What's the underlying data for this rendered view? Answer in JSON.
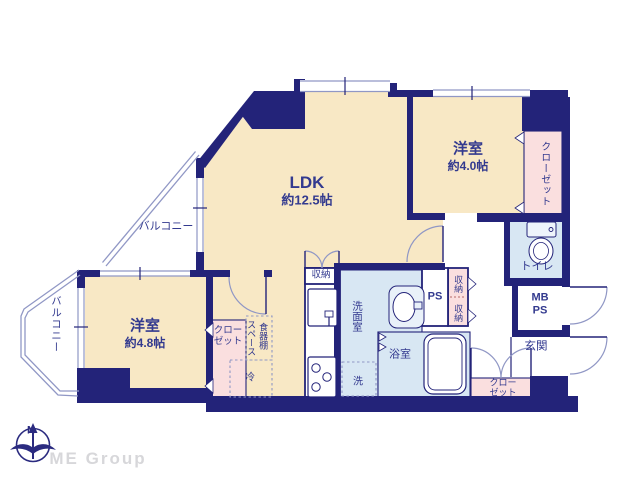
{
  "floorplan": {
    "rooms": {
      "ldk": {
        "label": "LDK",
        "area": "約12.5帖"
      },
      "bedroom_right": {
        "label": "洋室",
        "area": "約4.0帖"
      },
      "bedroom_left": {
        "label": "洋室",
        "area": "約4.8帖"
      },
      "balcony_upper": {
        "label": "バルコニー"
      },
      "balcony_left": {
        "label": "バルコニー"
      },
      "toilet": {
        "label": "トイレ"
      },
      "meter_box": {
        "line1": "MB",
        "line2": "PS"
      },
      "entrance": {
        "label": "玄関"
      },
      "washroom": {
        "label": "洗面室"
      },
      "bathroom": {
        "label": "浴室"
      },
      "closet_right": {
        "label": "クローゼット"
      },
      "closet_left": {
        "line1": "クロー",
        "line2": "ゼット"
      },
      "closet_entrance": {
        "line1": "クロー",
        "line2": "ゼット"
      },
      "storage_kitchen": {
        "label": "収納"
      },
      "storage_hall_upper": {
        "label": "収納"
      },
      "storage_hall_lower": {
        "label": "収納"
      },
      "pipe_space": {
        "label": "PS"
      },
      "cupboard_space": {
        "line1": "食器棚",
        "line2": "スペース"
      },
      "refrigerator": {
        "label": "冷"
      },
      "washer": {
        "label": "洗"
      }
    },
    "compass": {
      "north_label": "N"
    },
    "logo": {
      "text": "ME Group"
    },
    "colors": {
      "wall": "#232379",
      "floor_cream": "#f8e8c5",
      "closet_pink": "#fadfdf",
      "water_blue": "#d8e7f3",
      "thin_line": "#9097c5",
      "text_navy": "#333a8f"
    }
  }
}
